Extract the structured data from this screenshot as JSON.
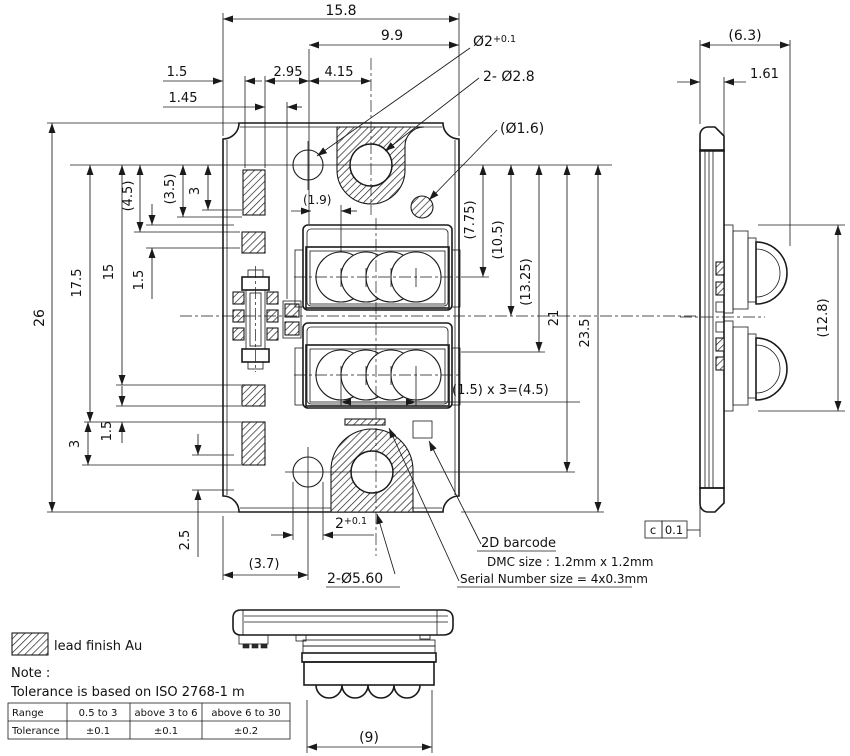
{
  "front_view": {
    "dim_overall_width": "15.8",
    "dim_9_9": "9.9",
    "dim_1_5_top": "1.5",
    "dim_2_95": "2.95",
    "dim_4_15": "4.15",
    "dim_1_45": "1.45",
    "dim_1_9": "(1.9)",
    "callout_phi2": "Ø2",
    "callout_phi2_tol": "+0.1",
    "callout_2_phi2_8": "2- Ø2.8",
    "callout_phi1_6": "(Ø1.6)",
    "dim_overall_height": "26",
    "dim_17_5": "17.5",
    "dim_15": "15",
    "dim_1_5_left": "1.5",
    "dim_4_5": "(4.5)",
    "dim_3_5": "(3.5)",
    "dim_3_top": "3",
    "dim_3_bottom": "3",
    "dim_1_5_bottom": "1.5",
    "dim_2_5": "2.5",
    "dim_7_75": "(7.75)",
    "dim_10_5": "(10.5)",
    "dim_13_25": "(13.25)",
    "dim_21": "21",
    "dim_23_5": "23.5",
    "dim_lens_pitch": "(1.5) x 3=(4.5)",
    "dim_2_base": "2",
    "dim_2_tol": "+0.1",
    "dim_3_7": "(3.7)",
    "callout_2_phi5_60": "2-Ø5.60"
  },
  "annotations": {
    "barcode_title": "2D barcode",
    "barcode_dmc": "DMC size : 1.2mm x 1.2mm",
    "barcode_serial": "Serial Number size = 4x0.3mm"
  },
  "side_view": {
    "dim_6_3": "(6.3)",
    "dim_1_61": "1.61",
    "dim_12_8": "(12.8)",
    "datum_letter": "c",
    "datum_value": "0.1"
  },
  "bottom_view": {
    "dim_9": "(9)"
  },
  "legend": {
    "swatch_label": "lead finish Au",
    "note_title": "Note :",
    "note_text": "Tolerance is based on ISO 2768-1 m"
  },
  "tolerance_table": {
    "rows": [
      {
        "label": "Range",
        "c1": "0.5 to 3",
        "c2": "above 3 to 6",
        "c3": "above 6 to 30"
      },
      {
        "label": "Tolerance",
        "c1": "±0.1",
        "c2": "±0.1",
        "c3": "±0.2"
      }
    ]
  }
}
